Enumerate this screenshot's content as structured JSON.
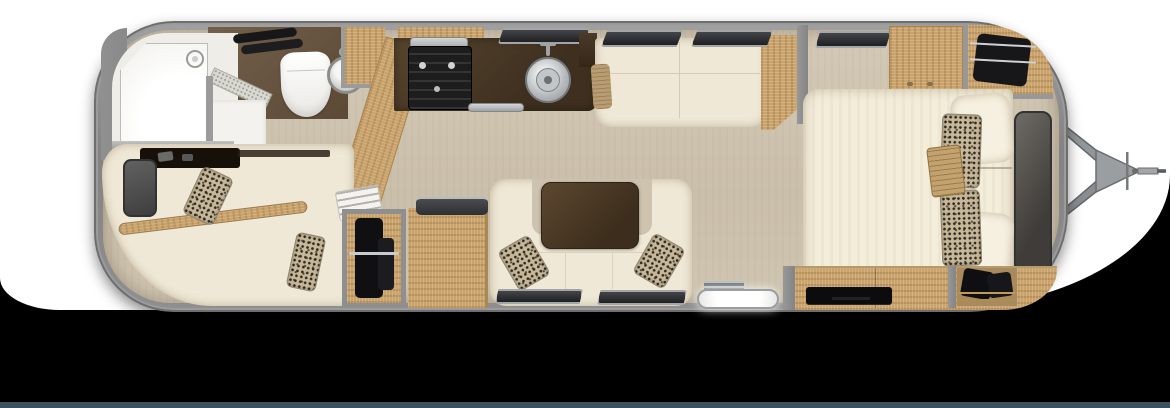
{
  "scene_type": "travel-trailer-floorplan-top-view",
  "colors": {
    "backdrop": "#000000",
    "card": "#ffffff",
    "footer_strip": "#3d515e",
    "shell": "#8f8f8f",
    "shell_dark": "#6e6e6e",
    "floor": "#cdc3af",
    "bath_floor": "#f0efeb",
    "bath_brown": "#6b5944",
    "counter": "#4a3927",
    "table": "#4e3b27",
    "wood": "#c9a36b",
    "wood_dark": "#a8854f",
    "cream": "#efe8d6",
    "leopard_base": "#c7b899",
    "dark_tv": "#4c4843",
    "black_appliance": "#1e1e1e",
    "steel": "#b9bdbf",
    "window_glass": "#26282a",
    "white_fixture": "#f7f6f2",
    "gold": "#bb9659"
  },
  "zones": {
    "rear_bath": [
      "shower",
      "shower-glass",
      "toilet",
      "bath-sink",
      "towel-bars",
      "bath-wardrobe",
      "angled-partition"
    ],
    "front_lounge": [
      "lounge-sofa",
      "lounge-tv",
      "credenza",
      "wood-rail",
      "leopard-pillows",
      "towel-stack"
    ],
    "galley": [
      "counter",
      "cooktop",
      "kitchen-sink",
      "kitchen-window",
      "counter-trim",
      "kitchen-shelf"
    ],
    "curbside_sofa": [
      "sofa-bench",
      "arm-pillow",
      "wood-end-panel",
      "windows"
    ],
    "u_dinette": [
      "u-sofa",
      "dinette-table",
      "leopard-pillows",
      "dinette-windows"
    ],
    "mid_storage": [
      "hanging-wardrobe",
      "cabinet-with-appliance-top"
    ],
    "entry": [
      "entry-step",
      "floor-grille"
    ],
    "bedroom": [
      "queen-bed",
      "cream-pillows",
      "leopard-pillows",
      "ribbed-pillow",
      "headboard-tv",
      "overhead-cabinet",
      "corner-wardrobe-hangers",
      "tv-credenza",
      "shoe-wardrobe",
      "bedroom-window"
    ],
    "exterior": [
      "trailer-shell",
      "a-frame-hitch",
      "coupler",
      "white-card-background",
      "slate-footer-strip"
    ]
  }
}
